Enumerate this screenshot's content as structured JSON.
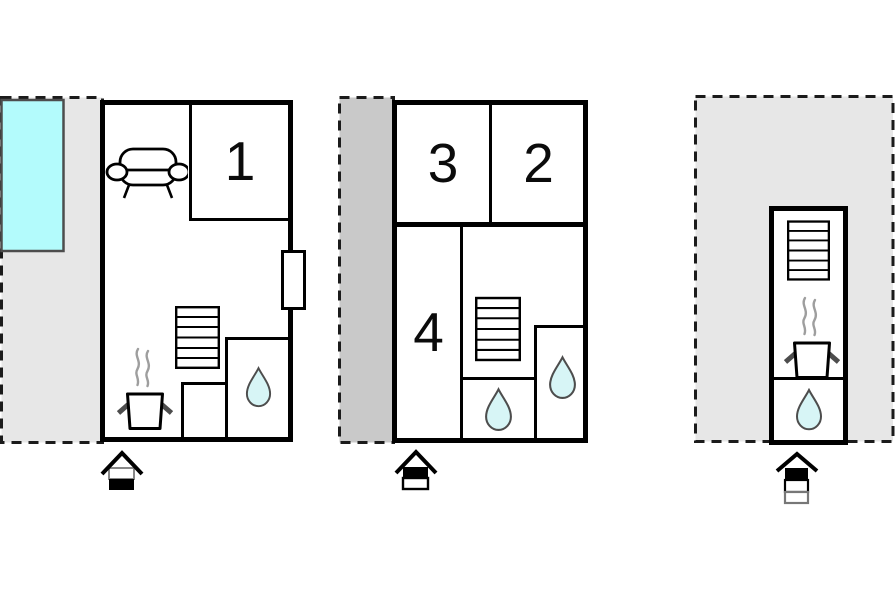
{
  "canvas": {
    "background": "#ffffff"
  },
  "colors": {
    "wall": "#000000",
    "terrace_fill": "#e7e7e7",
    "balcony_fill": "#c9c9c9",
    "pool_fill": "#b3fbfc",
    "drop_fill": "#d7f5f6",
    "outline": "#4d4d4d",
    "steam": "#9e9e9e",
    "dash": "#1b1b1b"
  },
  "plans": [
    {
      "name": "plan-left-ground-floor",
      "rooms": [
        {
          "label": "1"
        }
      ],
      "outdoor": [
        "terrace",
        "swimming-pool"
      ],
      "icons": [
        "sofa-icon",
        "door-window",
        "stairs-icon",
        "stove-icon",
        "water-drop-icon",
        "entrance-arrow-icon"
      ],
      "entrance_indicator_cells": [
        "white",
        "black"
      ]
    },
    {
      "name": "plan-middle-upper-floor",
      "rooms": [
        {
          "label": "3"
        },
        {
          "label": "2"
        },
        {
          "label": "4"
        }
      ],
      "outdoor": [
        "balcony"
      ],
      "icons": [
        "stairs-icon",
        "water-drop-icon",
        "water-drop-icon",
        "entrance-arrow-icon"
      ],
      "entrance_indicator_cells": [
        "black",
        "white"
      ]
    },
    {
      "name": "plan-right-annex",
      "rooms": [],
      "outdoor": [
        "terrace"
      ],
      "icons": [
        "stairs-icon",
        "stove-icon",
        "water-drop-icon",
        "entrance-arrow-icon"
      ],
      "entrance_indicator_cells": [
        "black",
        "white",
        "white"
      ]
    }
  ]
}
